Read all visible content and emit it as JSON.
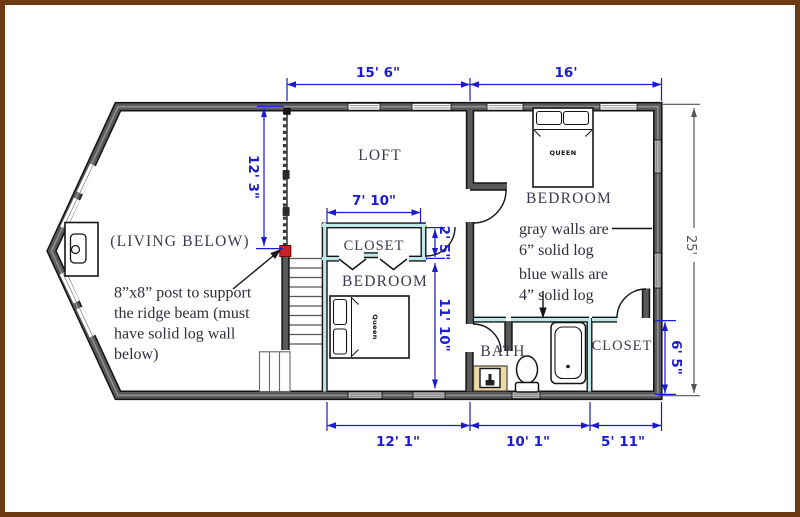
{
  "figure": {
    "type": "second floor / loft floor plan"
  },
  "colors": {
    "dimension_blue": "#1b1bd0",
    "dimension_gray": "#55555c",
    "wall_gray": "#58595b",
    "wall_blue": "#bfe9e9",
    "post_red": "#c92323",
    "border_brown": "#6e3a12",
    "vanity_tan": "#eed9a4"
  },
  "dimensions": {
    "loft_width": "15' 6\"",
    "bedroom_upper_width": "16'",
    "loft_depth": "12' 3\"",
    "closet_upper_width": "7' 10\"",
    "doorway": "2' 5\"",
    "bedroom_lower_depth": "11' 10\"",
    "overall_depth": "25'",
    "closet_lower_depth": "6' 5\"",
    "bedroom_lower_width": "12' 1\"",
    "bath_width": "10' 1\"",
    "closet_lower_width": "5' 11\""
  },
  "rooms": {
    "loft": "LOFT",
    "bedroom_upper": "BEDROOM",
    "bedroom_lower": "BEDROOM",
    "closet_upper": "CLOSET",
    "closet_lower": "CLOSET",
    "bath": "BATH",
    "living_below": "(LIVING BELOW)"
  },
  "furniture": {
    "bed_upper_label": "QUEEN",
    "bed_lower_label": "Queen"
  },
  "notes": {
    "post_line1": "8”x8” post to support",
    "post_line2": "the ridge beam (must",
    "post_line3": "have solid log wall",
    "post_line4": "below)",
    "gray_walls_line1": "gray walls are",
    "gray_walls_line2": "6” solid log",
    "blue_walls_line1": "blue walls are",
    "blue_walls_line2": "4” solid log"
  }
}
